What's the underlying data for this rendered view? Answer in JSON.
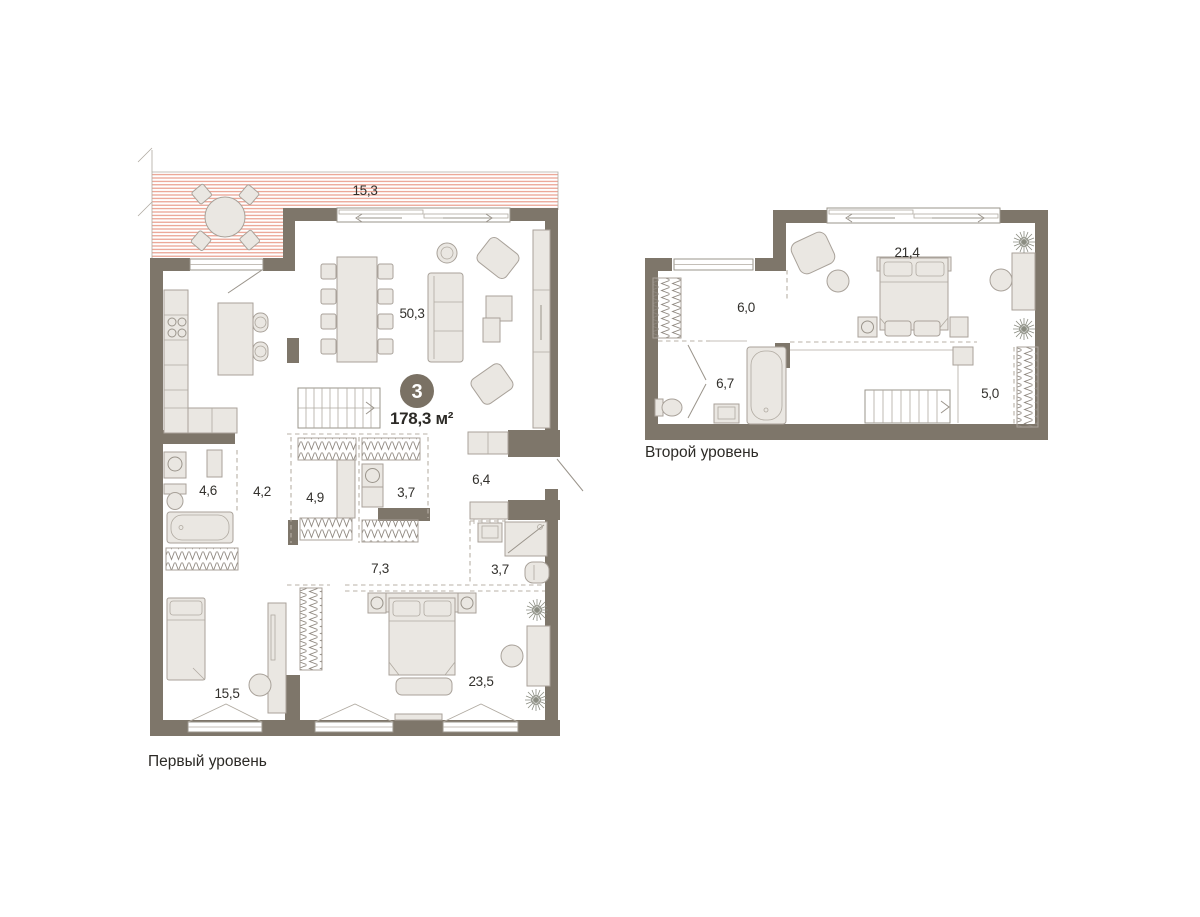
{
  "badge": {
    "rooms_count": "3",
    "total_area_label": "178,3 м²"
  },
  "levels": [
    {
      "caption": "Первый уровень",
      "rooms": [
        {
          "key": "terrace",
          "area": "15,3"
        },
        {
          "key": "kitchen-living-room",
          "area": "50,3"
        },
        {
          "key": "bathroom",
          "area": "4,6"
        },
        {
          "key": "hallway",
          "area": "4,2"
        },
        {
          "key": "wardrobe",
          "area": "4,9"
        },
        {
          "key": "laundry",
          "area": "3,7"
        },
        {
          "key": "entrance-hall",
          "area": "6,4"
        },
        {
          "key": "corridor",
          "area": "7,3"
        },
        {
          "key": "shower-room",
          "area": "3,7"
        },
        {
          "key": "bedroom",
          "area": "15,5"
        },
        {
          "key": "master-bedroom",
          "area": "23,5"
        }
      ]
    },
    {
      "caption": "Второй уровень",
      "rooms": [
        {
          "key": "hall",
          "area": "6,0"
        },
        {
          "key": "bathroom",
          "area": "6,7"
        },
        {
          "key": "bedroom",
          "area": "21,4"
        },
        {
          "key": "wardrobe",
          "area": "5,0"
        }
      ]
    }
  ],
  "colors": {
    "background": "#ffffff",
    "wall": "#7e766a",
    "furniture_fill": "#eae7e2",
    "furniture_stroke": "#a9a29a",
    "terrace_stripe": "#e79481",
    "dashed_line": "#b8b1a7",
    "text": "#33312d",
    "badge_background": "#7a7164",
    "badge_text": "#ffffff"
  }
}
